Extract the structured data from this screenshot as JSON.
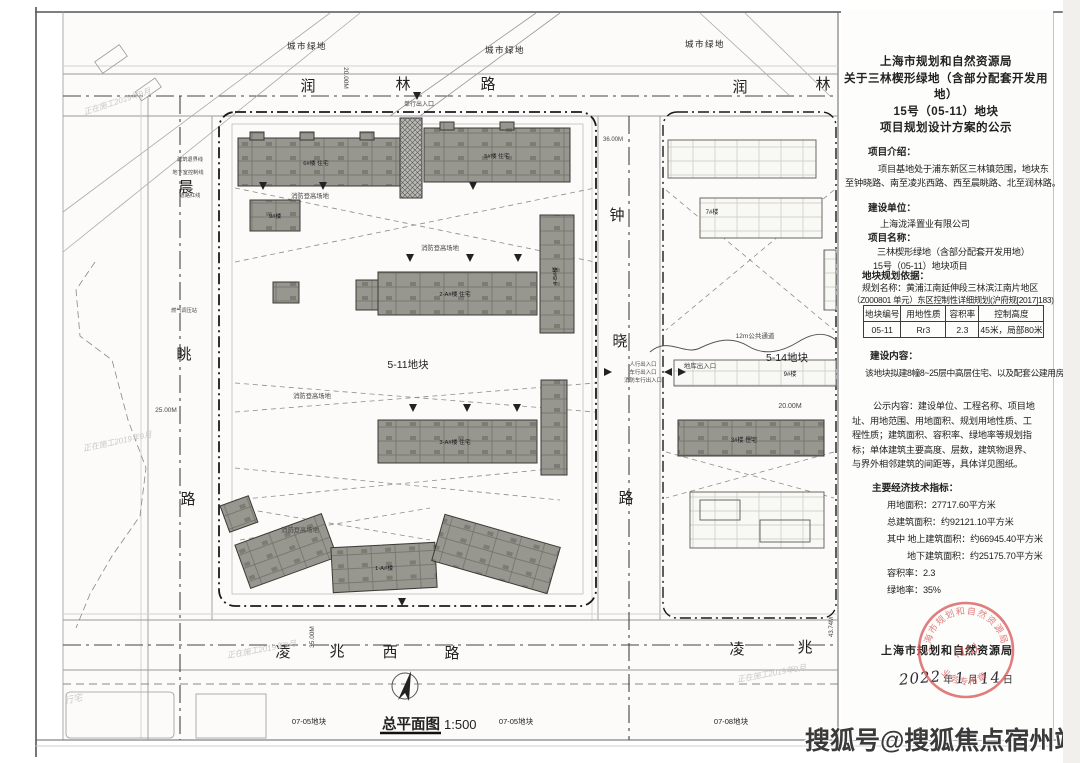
{
  "panel": {
    "title_lines": [
      "上海市规划和自然资源局",
      "关于三林楔形绿地（含部分配套开发用地）",
      "15号（05-11）地块",
      "项目规划设计方案的公示"
    ],
    "intro_heading": "项目介绍：",
    "intro_lines": [
      "项目基地处于浦东新区三林镇范围，地块东",
      "至钟晓路、南至凌兆西路、西至晨眺路、北至润林路。"
    ],
    "builder_heading": "建设单位：",
    "builder_name": "上海泷泽置业有限公司",
    "project_heading": "项目名称：",
    "project_lines": [
      "三林楔形绿地（含部分配套开发用地）",
      "15号（05-11）地块项目"
    ],
    "basis_heading": "地块规划依据：",
    "basis_line1": "规划名称：黄浦江南延伸段三林滨江南片地区",
    "basis_line2": "（Z000801 单元）东区控制性详细规划(沪府规[2017]183)",
    "table": {
      "headers": [
        "地块编号",
        "用地性质",
        "容积率",
        "控制高度"
      ],
      "rows": [
        [
          "05-11",
          "Rr3",
          "2.3",
          "45米，局部80米"
        ]
      ]
    },
    "content_heading": "建设内容：",
    "content_line": "该地块拟建8幢8~25层中高层住宅、以及配套公建用房。",
    "publicity_lines": [
      "公示内容：建设单位、工程名称、项目地",
      "址、用地范围、用地面积、规划用地性质、工",
      "程性质；建筑面积、容积率、绿地率等规划指",
      "标；单体建筑主要高度、层数，建筑物退界、",
      "与界外相邻建筑的间距等，具体详见图纸。"
    ],
    "indicators_heading": "主要经济技术指标：",
    "indicator_lines": [
      "用地面积：27717.60平方米",
      "总建筑面积：约92121.10平方米",
      "其中 地上建筑面积：约66945.40平方米",
      "地下建筑面积：约25175.70平方米",
      "容积率：2.3",
      "绿地率：35%"
    ],
    "footer_org": "上海市规划和自然资源局",
    "date": {
      "y": "2022",
      "yl": "年",
      "m": "1",
      "ml": "月",
      "d": "14",
      "dl": "日"
    },
    "stamp": {
      "arc_top": "上海市规划和自然资源局",
      "center": "（15）",
      "arc_bottom": "业务专用章"
    }
  },
  "map": {
    "green": "城市绿地",
    "rt0": "润",
    "rt1": "林",
    "rt2": "路",
    "rt3": "润",
    "rt4": "林",
    "rl0": "晨",
    "rl1": "眺",
    "rl2": "路",
    "rm0": "钟",
    "rm1": "晓",
    "rm2": "路",
    "rb0": "凌",
    "rb1": "兆",
    "rb2": "西",
    "rb3": "路",
    "rb4": "凌",
    "rb5": "兆",
    "p511": "5-11地块",
    "p514": "5-14地块",
    "p0705": "07-05地块",
    "p0708": "07-08地块",
    "scale_title": "总平面图",
    "scale_value": "1:500",
    "d20": "20.00M",
    "d25": "25.00M",
    "d35": "35.00M",
    "d36": "36.00M",
    "d43": "43.74M",
    "passage": "12m公共通道",
    "garage": "地库出入口",
    "entry_ped": "人行出入口",
    "entry_car": "车行出入口",
    "entry_fire": "消防车行出入口",
    "entry_single": "单行出入口",
    "fire_area": "消防登高场地",
    "gas": "燃气调压站",
    "red_line": "道路红线",
    "setback": "建筑退界线",
    "basement_line": "地下室控制线",
    "construction": "正在施工2019年9月",
    "xingzhai": "行宅",
    "b6": "6#楼 住宅",
    "b5": "5#楼 住宅",
    "b9s": "9#楼",
    "b2a": "2-A#楼 住宅",
    "b3a": "3-A#楼 住宅",
    "b1a": "1-A#楼",
    "b4b": "4-B#楼",
    "b7": "7#楼",
    "b9": "9#楼",
    "b3": "3#楼 住宅"
  },
  "watermark": {
    "text": "搜狐号@搜狐焦点宿州站"
  }
}
